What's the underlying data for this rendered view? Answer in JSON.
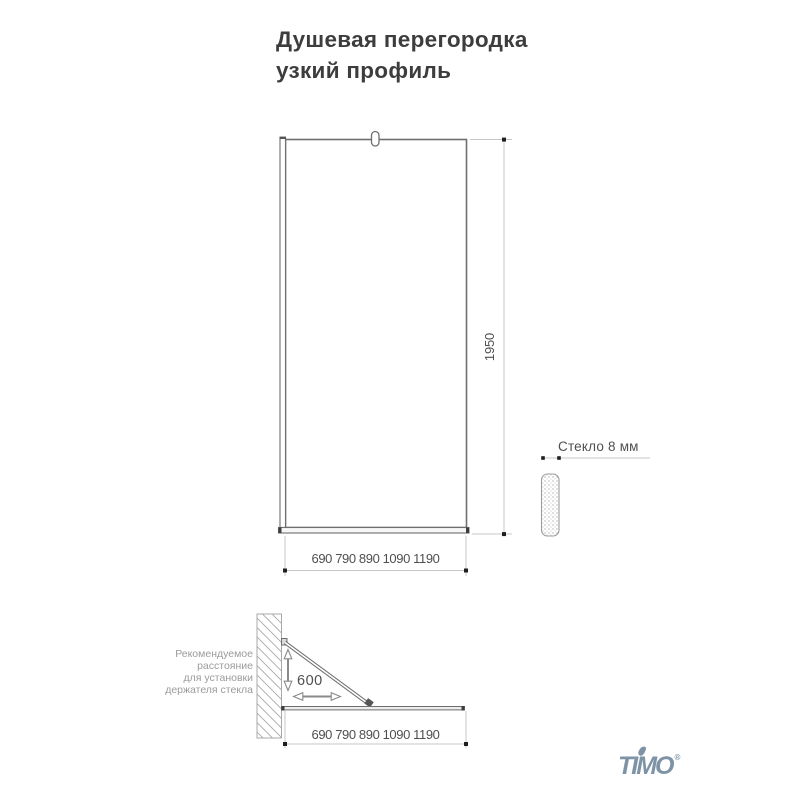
{
  "colors": {
    "line": "#6f6f6f",
    "light": "#c7c7c7",
    "dot": "#1f1f1f",
    "hatch": "#a8a8a8",
    "dim_text": "#4f4f4f",
    "muted_text": "#9b9b9b",
    "title_text": "#3d3d3d",
    "logo": "#7e93a5"
  },
  "title": {
    "line1": "Душевая перегородка",
    "line2": "узкий профиль"
  },
  "front_view": {
    "height_dim": "1950",
    "width_dim": "690 790 890 1090 1190"
  },
  "glass_detail": {
    "label": "Стекло 8 мм"
  },
  "top_view": {
    "holder_note_lines": [
      "Рекомендуемое",
      "расстояние",
      "для установки",
      "держателя стекла"
    ],
    "holder_distance": "600",
    "width_dim": "690 790 890 1090 1190"
  },
  "logo": {
    "text": "TIMO",
    "registered": "®"
  }
}
